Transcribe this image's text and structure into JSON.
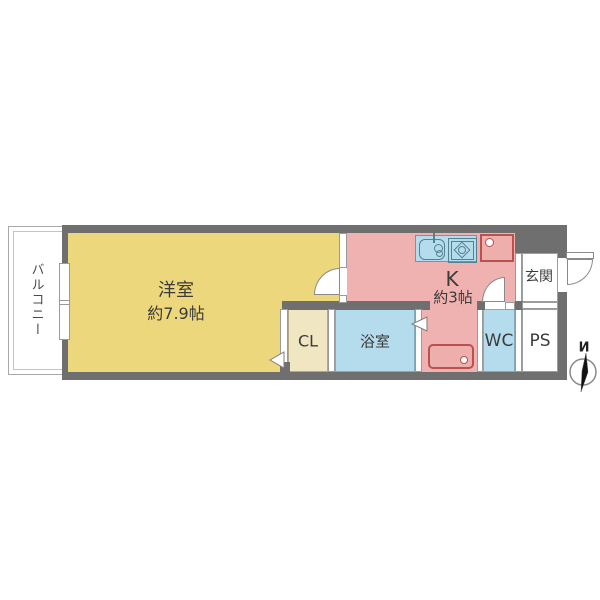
{
  "rooms": {
    "balcony": {
      "label": "バルコニー"
    },
    "western": {
      "label": "洋室",
      "size": "約7.9帖"
    },
    "kitchen": {
      "label": "K",
      "size": "約3帖"
    },
    "closet": {
      "label": "CL"
    },
    "bath": {
      "label": "浴室"
    },
    "wc": {
      "label": "WC"
    },
    "pipe_space": {
      "label": "PS"
    },
    "entrance": {
      "label": "玄関"
    }
  },
  "compass": {
    "north_label": "N"
  },
  "colors": {
    "wall": "#6f6f6f",
    "western_room": "#ecd77c",
    "closet": "#f1e6c2",
    "kitchen": "#efb2b0",
    "water_rooms": "#b5dcec",
    "fixture_red_border": "#b9524e",
    "fixture_red_fill": "#edaeac"
  }
}
